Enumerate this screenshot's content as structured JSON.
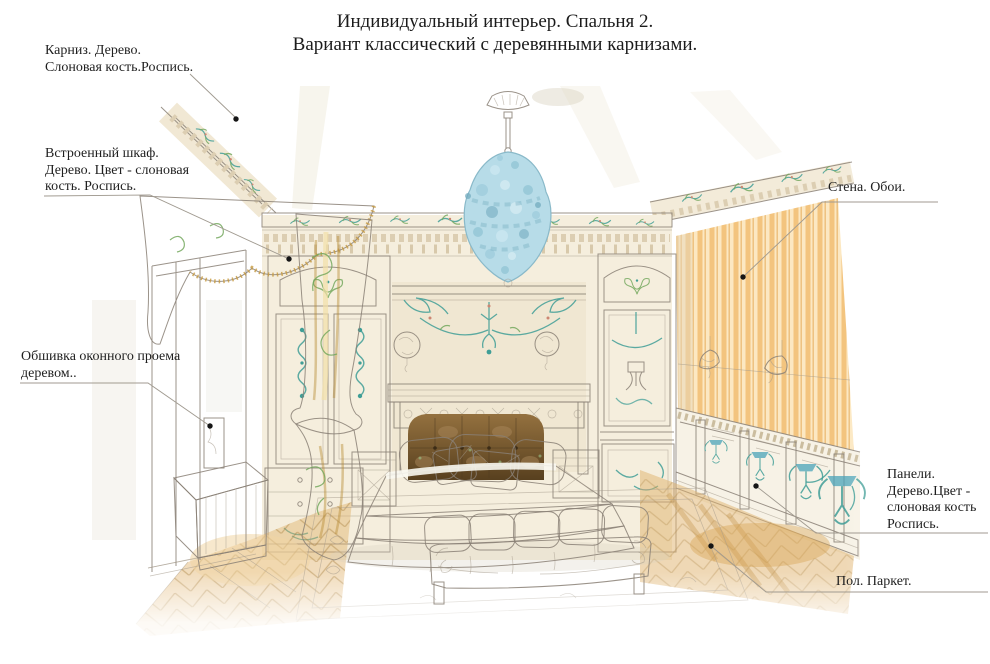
{
  "title": {
    "line1": "Индивидуальный интерьер. Спальня 2.",
    "line2": "Вариант классический с деревянными карнизами."
  },
  "annotations": {
    "cornice": {
      "text": "Карниз. Дерево.\nСлоновая кость.Роспись."
    },
    "wardrobe": {
      "text": "Встроенный шкаф.\nДерево. Цвет - слоновая\nкость. Роспись."
    },
    "window_trim": {
      "text": "Обшивка оконного проема\nдеревом.."
    },
    "wall": {
      "text": "Стена. Обои."
    },
    "panels": {
      "text": "Панели.\nДерево.Цвет -\nслоновая кость\nРоспись."
    },
    "floor": {
      "text": "Пол. Паркет."
    }
  },
  "colors": {
    "painted_ornament_teal": "#3f9e96",
    "curtain_gold": "#d8ae4e",
    "wallpaper_stripe": "#f3c47e",
    "chandelier_blue": "#b7dce8",
    "bedspread_green": "#9cc58b",
    "headboard_brown": "#6b5335",
    "parquet_gold": "#dfae66",
    "ivory_wood": "#f4ecda"
  }
}
